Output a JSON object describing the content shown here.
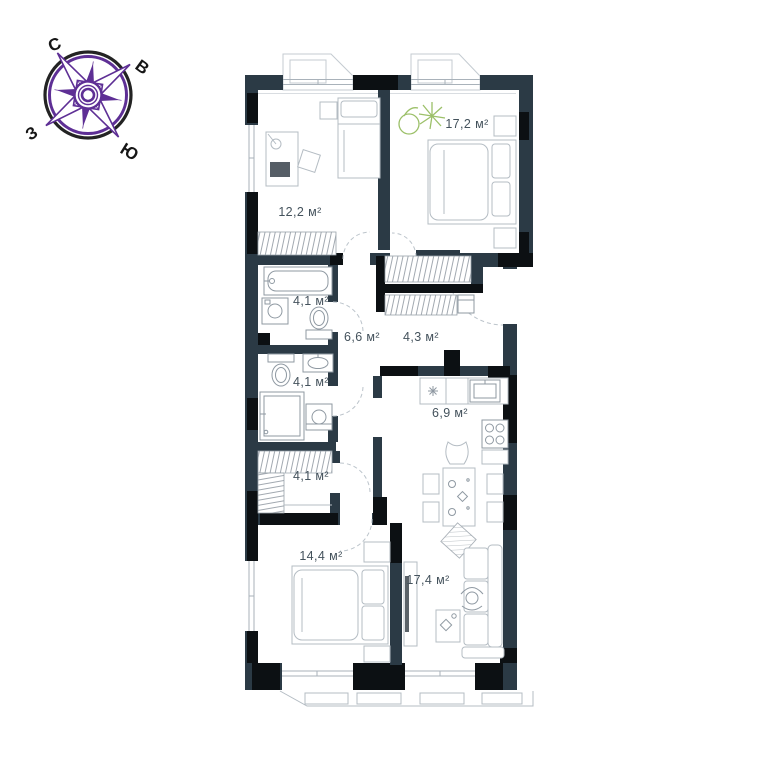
{
  "plan_title": "apartment floor plan",
  "compass": {
    "north": "С",
    "east": "В",
    "south": "Ю",
    "west": "З"
  },
  "rooms": [
    {
      "name": "bedroom-top",
      "label": "17,2 м²"
    },
    {
      "name": "study",
      "label": "12,2 м²"
    },
    {
      "name": "bathroom-1",
      "label": "4,1 м²"
    },
    {
      "name": "hallway",
      "label": "6,6 м²"
    },
    {
      "name": "entry-hall",
      "label": "4,3 м²"
    },
    {
      "name": "bathroom-2",
      "label": "4,1 м²"
    },
    {
      "name": "kitchen",
      "label": "6,9 м²"
    },
    {
      "name": "wardrobe",
      "label": "4,1 м²"
    },
    {
      "name": "bedroom-bottom",
      "label": "14,4 м²"
    },
    {
      "name": "living-room",
      "label": "17,4 м²"
    }
  ],
  "colors": {
    "wall": "#2b3a45",
    "wall_accent": "#0c1013",
    "furniture_line": "#b4bcc3",
    "fixture_line": "#8f99a2",
    "label_text": "#44525c",
    "plant_green": "#9cc069",
    "compass_purple": "#5e2f95",
    "compass_ring": "#232323"
  }
}
